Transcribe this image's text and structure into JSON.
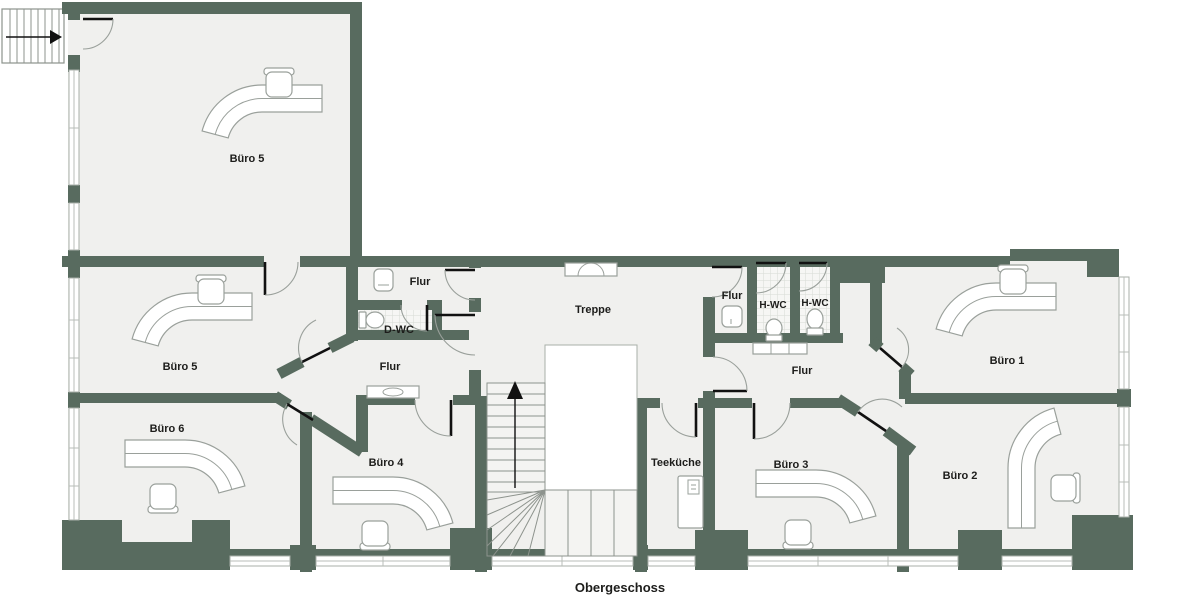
{
  "title": "Obergeschoss",
  "colors": {
    "wall": "#586b5f",
    "floor": "#f0f0ee",
    "tile_floor": "#f6f6f4",
    "tile_line": "#d7dbd5",
    "window_line": "#a9afa8",
    "furniture_line": "#9aa09b",
    "door_leaf": "#111111",
    "text": "#1d1d1b",
    "outside": "#ffffff"
  },
  "rooms": {
    "buero5_top": {
      "label": "Büro 5"
    },
    "buero5": {
      "label": "Büro 5"
    },
    "buero6": {
      "label": "Büro 6"
    },
    "buero4": {
      "label": "Büro 4"
    },
    "flur_top": {
      "label": "Flur"
    },
    "dwc": {
      "label": "D-WC"
    },
    "flur_mid": {
      "label": "Flur"
    },
    "treppe": {
      "label": "Treppe"
    },
    "flur_small_right": {
      "label": "Flur"
    },
    "hwc1": {
      "label": "H-WC"
    },
    "hwc2": {
      "label": "H-WC"
    },
    "flur_right": {
      "label": "Flur"
    },
    "teekueche": {
      "label": "Teeküche"
    },
    "buero3": {
      "label": "Büro 3"
    },
    "buero2": {
      "label": "Büro 2"
    },
    "buero1": {
      "label": "Büro 1"
    }
  }
}
